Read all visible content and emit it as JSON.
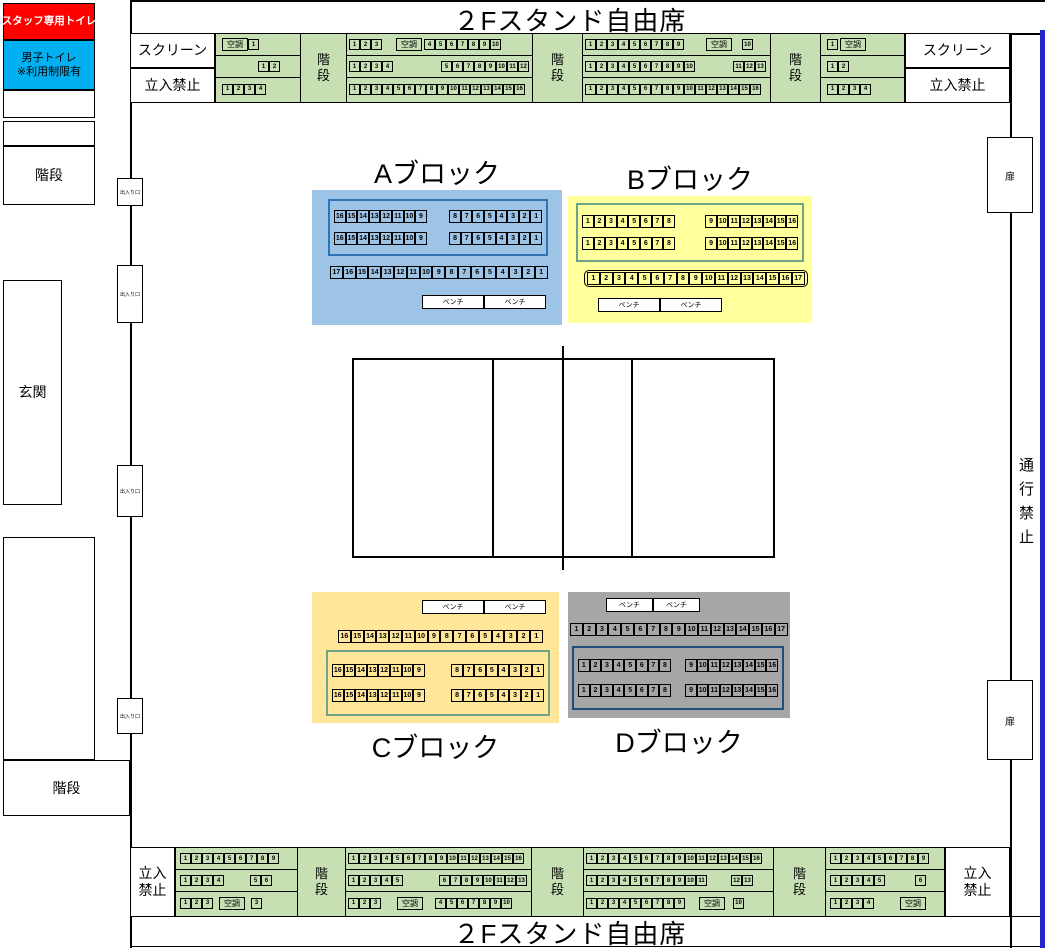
{
  "titles": {
    "top": "２Fスタンド自由席",
    "bottom": "２Fスタンド自由席"
  },
  "labels": {
    "screen": "スクリーン",
    "no_entry": "立入禁止",
    "stairs": "階段",
    "ac": "空調",
    "bench": "ベンチ",
    "door": "扉",
    "doorway": "出入り口",
    "no_passage": "通行禁止"
  },
  "left_wing": {
    "staff_toilet": "スタッフ専用トイレ",
    "mens_toilet": "男子トイレ",
    "mens_toilet_note": "※利用制限有",
    "stairs_top": "階段",
    "entrance": "玄関",
    "stairs_bottom": "階段"
  },
  "colors": {
    "strip_green": "#C6E0B4",
    "staff_red": "#FF0000",
    "toilet_blue": "#00B0F0",
    "right_line_blue": "#2323CC"
  },
  "top_strip": [
    {
      "type": "section",
      "w": 85,
      "rows": [
        [
          {
            "g": 4
          },
          {
            "ac": true
          },
          {
            "s": [
              1
            ]
          }
        ],
        [
          {
            "g": 40
          },
          {
            "s": [
              1,
              2
            ]
          }
        ],
        [
          {
            "g": 4
          },
          {
            "s": [
              1,
              2,
              3,
              4
            ]
          }
        ]
      ]
    },
    {
      "type": "stairs",
      "w": 46
    },
    {
      "type": "section",
      "w": 186,
      "rows": [
        [
          {
            "s": [
              1,
              2,
              3
            ]
          },
          {
            "g": 14
          },
          {
            "ac": true
          },
          {
            "g": 2
          },
          {
            "s": [
              4,
              5,
              6,
              7,
              8,
              9,
              10
            ]
          }
        ],
        [
          {
            "s": [
              1,
              2,
              3,
              4
            ]
          },
          {
            "g": 48
          },
          {
            "s": [
              5,
              6,
              7,
              8,
              9,
              10,
              11,
              12
            ]
          }
        ],
        [
          {
            "s": [
              1,
              2,
              3,
              4,
              5,
              6,
              7,
              8,
              9,
              10,
              11,
              12,
              13,
              14,
              15,
              16
            ]
          }
        ]
      ]
    },
    {
      "type": "stairs",
      "w": 50
    },
    {
      "type": "section",
      "w": 188,
      "rows": [
        [
          {
            "s": [
              1,
              2,
              3,
              4,
              5,
              6,
              7,
              8,
              9
            ]
          },
          {
            "g": 22
          },
          {
            "ac": true
          },
          {
            "g": 10
          },
          {
            "s": [
              10
            ]
          }
        ],
        [
          {
            "s": [
              1,
              2,
              3,
              4,
              5,
              6,
              7,
              8,
              9,
              10
            ]
          },
          {
            "g": 38
          },
          {
            "s": [
              11,
              12,
              13
            ]
          }
        ],
        [
          {
            "s": [
              1,
              2,
              3,
              4,
              5,
              6,
              7,
              8,
              9,
              10,
              11,
              12,
              13,
              14,
              15,
              16
            ]
          }
        ]
      ]
    },
    {
      "type": "stairs",
      "w": 50
    },
    {
      "type": "section",
      "w": 85,
      "rows": [
        [
          {
            "g": 4
          },
          {
            "s": [
              1
            ]
          },
          {
            "g": 2
          },
          {
            "ac": true
          }
        ],
        [
          {
            "g": 4
          },
          {
            "s": [
              1,
              2
            ]
          }
        ],
        [
          {
            "g": 4
          },
          {
            "s": [
              1,
              2,
              3,
              4
            ]
          }
        ]
      ]
    }
  ],
  "bottom_strip": [
    {
      "type": "section",
      "w": 122,
      "rows": [
        [
          {
            "g": 2
          },
          {
            "s": [
              1,
              2,
              3,
              4,
              5,
              6,
              7,
              8,
              9
            ]
          }
        ],
        [
          {
            "g": 2
          },
          {
            "s": [
              1,
              2,
              3,
              4
            ]
          },
          {
            "g": 26
          },
          {
            "s": [
              5,
              6
            ]
          }
        ],
        [
          {
            "g": 2
          },
          {
            "s": [
              1,
              2,
              3
            ]
          },
          {
            "g": 6
          },
          {
            "ac": true
          },
          {
            "g": 6
          },
          {
            "s": [
              3
            ]
          }
        ]
      ]
    },
    {
      "type": "stairs",
      "w": 48
    },
    {
      "type": "section",
      "w": 186,
      "rows": [
        [
          {
            "s": [
              1,
              2,
              3,
              4,
              5,
              6,
              7,
              8,
              9,
              10,
              11,
              12,
              13,
              14,
              15,
              16
            ]
          }
        ],
        [
          {
            "s": [
              1,
              2,
              3,
              4,
              5
            ]
          },
          {
            "g": 36
          },
          {
            "s": [
              6,
              7,
              8,
              9,
              10,
              11,
              12,
              13
            ]
          }
        ],
        [
          {
            "s": [
              1,
              2,
              3
            ]
          },
          {
            "g": 16
          },
          {
            "ac": true
          },
          {
            "g": 12
          },
          {
            "s": [
              4,
              5,
              6,
              7,
              8,
              9,
              10
            ]
          }
        ]
      ]
    },
    {
      "type": "stairs",
      "w": 52
    },
    {
      "type": "section",
      "w": 190,
      "rows": [
        [
          {
            "s": [
              1,
              2,
              3,
              4,
              5,
              6,
              7,
              8,
              9,
              10,
              11,
              12,
              13,
              14,
              15,
              16
            ]
          }
        ],
        [
          {
            "s": [
              1,
              2,
              3,
              4,
              5,
              6,
              7,
              8,
              9,
              10,
              11
            ]
          },
          {
            "g": 24
          },
          {
            "s": [
              12,
              13
            ]
          }
        ],
        [
          {
            "s": [
              1,
              2,
              3,
              4,
              5,
              6,
              7,
              8,
              9
            ]
          },
          {
            "g": 14
          },
          {
            "ac": true
          },
          {
            "g": 8
          },
          {
            "s": [
              10
            ]
          }
        ]
      ]
    },
    {
      "type": "stairs",
      "w": 52
    },
    {
      "type": "section",
      "w": 120,
      "rows": [
        [
          {
            "g": 2
          },
          {
            "s": [
              1,
              2,
              3,
              4,
              5,
              6,
              7,
              8,
              9
            ]
          }
        ],
        [
          {
            "g": 2
          },
          {
            "s": [
              1,
              2,
              3,
              4,
              5
            ]
          },
          {
            "g": 30
          },
          {
            "s": [
              6
            ]
          }
        ],
        [
          {
            "g": 2
          },
          {
            "s": [
              1,
              2,
              3,
              4
            ]
          },
          {
            "g": 26
          },
          {
            "ac": true
          }
        ]
      ]
    }
  ],
  "blocks": [
    {
      "id": "a",
      "title": "Aブロック",
      "title_pos": "above",
      "bg": "#9DC3E6",
      "box_border": "#2E75B6",
      "x": 312,
      "y": 190,
      "w": 250,
      "h": 135,
      "box": {
        "x": 16,
        "y": 9,
        "w": 220,
        "h": 57,
        "rows": [
          {
            "left": [
              16,
              15,
              14,
              13,
              12,
              11,
              10,
              9
            ],
            "right": [
              8,
              7,
              6,
              5,
              4,
              3,
              2,
              1
            ]
          },
          {
            "left": [
              16,
              15,
              14,
              13,
              12,
              11,
              10,
              9
            ],
            "right": [
              8,
              7,
              6,
              5,
              4,
              3,
              2,
              1
            ]
          }
        ]
      },
      "long_row": {
        "x": 18,
        "y": 76,
        "rounded": false,
        "nums": [
          17,
          16,
          15,
          14,
          13,
          12,
          11,
          10,
          9,
          8,
          7,
          6,
          5,
          4,
          3,
          2,
          1
        ]
      },
      "bench": {
        "x": 110,
        "y": 105,
        "w": 62
      }
    },
    {
      "id": "b",
      "title": "Bブロック",
      "title_pos": "above",
      "bg": "#FFFF9C",
      "box_border": "#6FA287",
      "x": 568,
      "y": 196,
      "w": 244,
      "h": 127,
      "box": {
        "x": 8,
        "y": 7,
        "w": 228,
        "h": 59,
        "rows": [
          {
            "left": [
              1,
              2,
              3,
              4,
              5,
              6,
              7,
              8
            ],
            "right": [
              9,
              10,
              11,
              12,
              13,
              14,
              15,
              16
            ]
          },
          {
            "left": [
              1,
              2,
              3,
              4,
              5,
              6,
              7,
              8
            ],
            "right": [
              9,
              10,
              11,
              12,
              13,
              14,
              15,
              16
            ]
          }
        ]
      },
      "long_row": {
        "x": 16,
        "y": 74,
        "rounded": true,
        "nums": [
          1,
          2,
          3,
          4,
          5,
          6,
          7,
          8,
          9,
          10,
          11,
          12,
          13,
          14,
          15,
          16,
          17
        ]
      },
      "bench": {
        "x": 30,
        "y": 102,
        "w": 62
      }
    },
    {
      "id": "c",
      "title": "Cブロック",
      "title_pos": "below",
      "bg": "#FFE699",
      "box_border": "#6FA287",
      "x": 312,
      "y": 592,
      "w": 247,
      "h": 131,
      "box": {
        "x": 14,
        "y": 58,
        "w": 224,
        "h": 66,
        "rows": [
          {
            "left": [
              16,
              15,
              14,
              13,
              12,
              11,
              10,
              9
            ],
            "right": [
              8,
              7,
              6,
              5,
              4,
              3,
              2,
              1
            ]
          },
          {
            "left": [
              16,
              15,
              14,
              13,
              12,
              11,
              10,
              9
            ],
            "right": [
              8,
              7,
              6,
              5,
              4,
              3,
              2,
              1
            ]
          }
        ]
      },
      "long_row": {
        "x": 26,
        "y": 38,
        "rounded": false,
        "nums": [
          16,
          15,
          14,
          13,
          12,
          11,
          10,
          9,
          8,
          7,
          6,
          5,
          4,
          3,
          2,
          1
        ]
      },
      "bench": {
        "x": 110,
        "y": 8,
        "w": 62
      }
    },
    {
      "id": "d",
      "title": "Dブロック",
      "title_pos": "below",
      "bg": "#A6A6A6",
      "box_border": "#1F4E79",
      "x": 568,
      "y": 592,
      "w": 222,
      "h": 126,
      "box": {
        "x": 4,
        "y": 54,
        "w": 212,
        "h": 64,
        "rows": [
          {
            "left": [
              1,
              2,
              3,
              4,
              5,
              6,
              7,
              8
            ],
            "right": [
              9,
              10,
              11,
              12,
              13,
              14,
              15,
              16
            ]
          },
          {
            "left": [
              1,
              2,
              3,
              4,
              5,
              6,
              7,
              8
            ],
            "right": [
              9,
              10,
              11,
              12,
              13,
              14,
              15,
              16
            ]
          }
        ]
      },
      "long_row": {
        "x": 2,
        "y": 31,
        "rounded": false,
        "nums": [
          1,
          2,
          3,
          4,
          5,
          6,
          7,
          8,
          9,
          10,
          11,
          12,
          13,
          14,
          15,
          16,
          17
        ]
      },
      "bench": {
        "x": 38,
        "y": 6,
        "w": 47
      }
    }
  ]
}
